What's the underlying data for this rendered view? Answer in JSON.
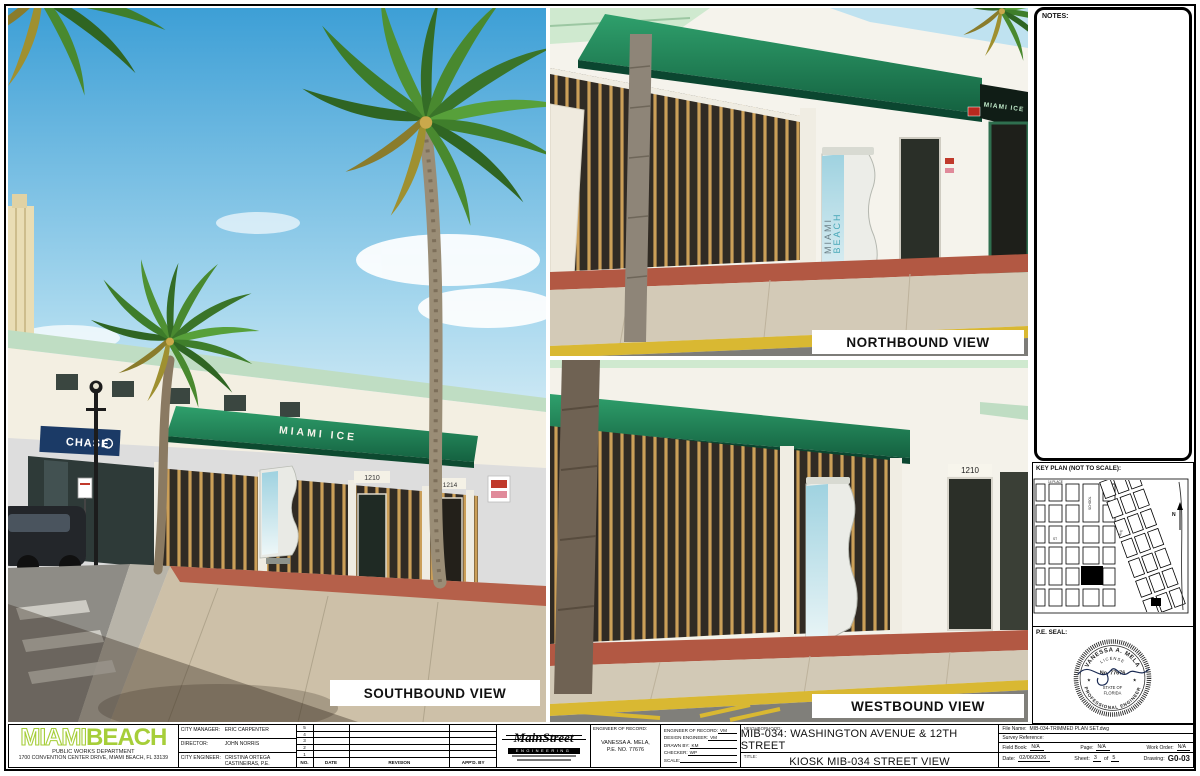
{
  "colors": {
    "accent_green": "#a6ce39",
    "awning_green": "#1f7a52",
    "sheet_border": "#000000"
  },
  "photos": {
    "southbound": {
      "label": "SOUTHBOUND VIEW",
      "chase_sign": "CHASE",
      "awning_sign": "MIAMI ICE",
      "address_left": "1210",
      "address_right": "1214"
    },
    "northbound": {
      "label": "NORTHBOUND VIEW",
      "storefront_sign": "MIAMI ICE",
      "kiosk_line1": "MIAMI",
      "kiosk_line2": "BEACH"
    },
    "westbound": {
      "label": "WESTBOUND VIEW",
      "address": "1210"
    }
  },
  "right_panel": {
    "notes_label": "NOTES:",
    "keyplan": {
      "title": "KEY PLAN (NOT TO SCALE):",
      "north_label": "N",
      "street_label_1": "14 PLACE",
      "street_label_2": "SCHOOL",
      "street_label_3": "AVE",
      "street_label_4": "ST"
    },
    "pe_seal": {
      "label": "P.E. SEAL:",
      "name": "VANESSA A. MELA",
      "license": "LICENSE",
      "number": "No. 77676",
      "state_line1": "STATE OF",
      "state_line2": "FLORIDA",
      "profession": "PROFESSIONAL ENGINEER",
      "star": "★"
    }
  },
  "titleblock": {
    "agency": {
      "logo_part1": "MIAMI",
      "logo_part2": "BEACH",
      "department": "PUBLIC WORKS DEPARTMENT",
      "address": "1700 CONVENTION CENTER DRIVE, MIAMI BEACH, FL 33139"
    },
    "officials": [
      {
        "label": "CITY MANAGER:",
        "value": "ERIC CARPENTER"
      },
      {
        "label": "DIRECTOR:",
        "value": "JOHN NORRIS"
      },
      {
        "label": "CITY ENGINEER:",
        "value": "CRISTINA ORTEGA CASTINEIRAS, P.E."
      }
    ],
    "revisions": {
      "row_numbers": [
        "5",
        "4",
        "3",
        "2",
        "1"
      ],
      "headers": [
        "NO.",
        "DATE",
        "REVISION",
        "APP'D. BY"
      ]
    },
    "consultant": {
      "name": "MainStreet",
      "subtitle": "ENGINEERING"
    },
    "engineer_of_record": {
      "label": "ENGINEER OF RECORD:",
      "name": "VANESSA A. MELA,",
      "pe_no": "P.E. NO. 77676"
    },
    "credits": [
      {
        "label": "ENGINEER OF RECORD:",
        "value": "VM"
      },
      {
        "label": "DESIGN ENGINEER:",
        "value": "VM"
      },
      {
        "label": "DRAWN BY:",
        "value": "KM"
      },
      {
        "label": "CHECKER:",
        "value": "WP"
      },
      {
        "label": "SCALE:",
        "value": ""
      }
    ],
    "neighborhood": {
      "label": "NEIGHBORHOOD:",
      "value": "MIB-034: WASHINGTON AVENUE & 12TH STREET"
    },
    "sheet_title": {
      "label": "TITLE:",
      "value": "KIOSK MIB-034 STREET VIEW"
    },
    "meta": {
      "file_name_label": "File Name:",
      "file_name": "MIB-034-TRIMMED PLAN SET.dwg",
      "survey_label": "Survey Reference:",
      "field_book_label": "Field Book:",
      "field_book": "N/A",
      "page_label": "Page:",
      "page": "N/A",
      "work_order_label": "Work Order:",
      "work_order": "N/A",
      "date_label": "Date:",
      "date": "02/06/2026",
      "sheet_label": "Sheet:",
      "sheet_number": "3",
      "sheet_of": "of",
      "sheet_total": "5",
      "drawing_label": "Drawing:",
      "drawing_number": "G0-03"
    }
  }
}
